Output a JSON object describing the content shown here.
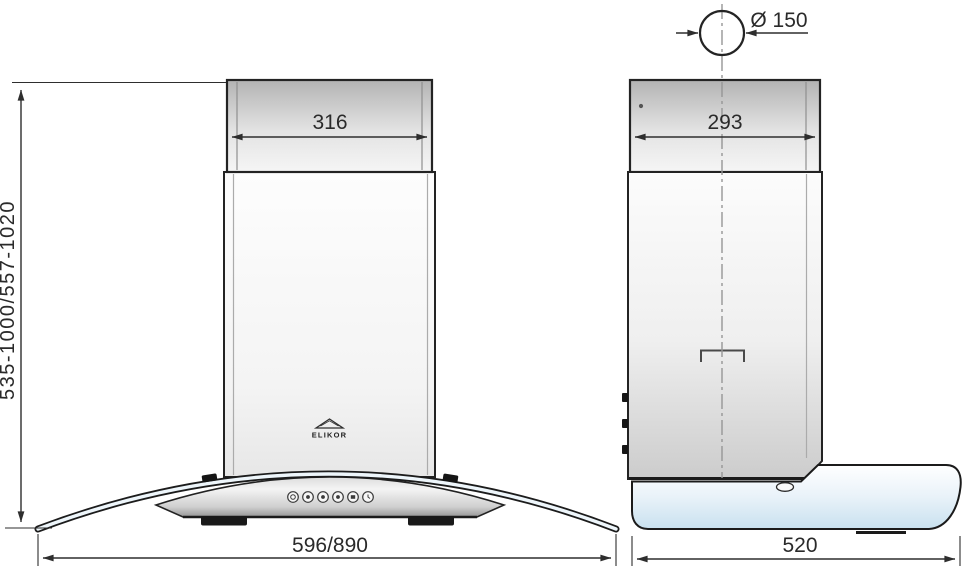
{
  "drawing": {
    "brand": "ELIKOR",
    "front_view": {
      "chimney_width": "316",
      "height_range": "535-1000/557-1020",
      "body_width": "596/890"
    },
    "side_view": {
      "duct_diameter": "Ø 150",
      "chimney_depth": "293",
      "body_depth": "520"
    },
    "colors": {
      "outline": "#1e1e1e",
      "dimension_line": "#2e2e2e",
      "centerline": "#969696",
      "metal_dark": "#b3b3b3",
      "metal_light": "#f5f5f5",
      "glass_blue": "#c9e1ef",
      "background": "#ffffff"
    }
  }
}
